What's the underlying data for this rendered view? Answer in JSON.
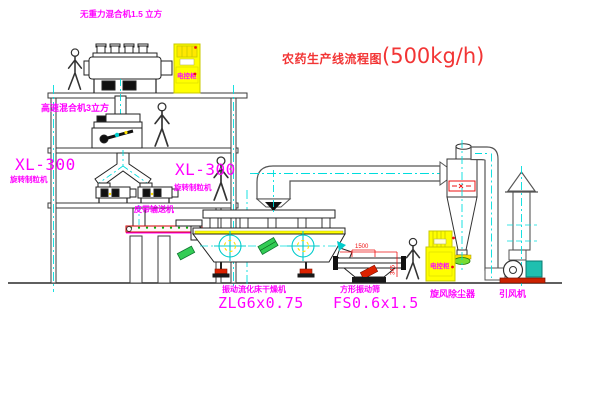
{
  "title": {
    "text_cn": "农药生产线流程图",
    "capacity": "(500kg/h)"
  },
  "equipment_labels": {
    "gravity_mixer": "无重力混合机1.5 立方",
    "high_speed_mixer": "高速混合机3立方",
    "granulator_left_model": "XL-300",
    "granulator_left_name": "旋转制粒机",
    "granulator_right_model": "XL-300",
    "granulator_right_name": "旋转制粒机",
    "belt_conveyor": "皮带输送机",
    "fluid_bed_dryer_name": "振动流化床干燥机",
    "fluid_bed_dryer_model": "ZLG6x0.75",
    "square_sieve_name": "方形振动筛",
    "square_sieve_model": "FS0.6x1.5",
    "cyclone": "旋风除尘器",
    "induced_draft_fan": "引风机",
    "control_cabinet": "电控柜"
  },
  "dimensions": {
    "sieve_length": "1500",
    "sieve_height": "345"
  },
  "colors": {
    "label_magenta": "#FF00FF",
    "title_red": "#F23535",
    "centerline_cyan": "#00DDDD",
    "cabinet_yellow": "#FFFF00",
    "dimension_red": "#EE1111",
    "structure_gray": "#3a3a3a"
  }
}
